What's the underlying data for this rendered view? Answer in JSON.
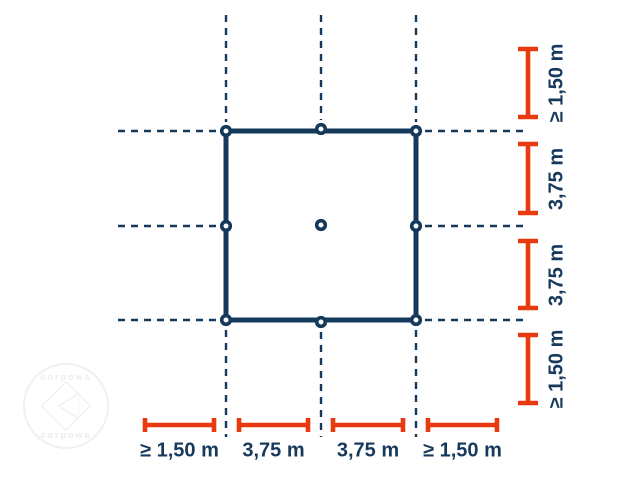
{
  "canvas": {
    "width": 639,
    "height": 479,
    "background": "#ffffff"
  },
  "colors": {
    "navy": "#14395B",
    "red": "#E8390F",
    "label_text": "#17395C",
    "watermark": "#F0F0F0"
  },
  "square": {
    "x": 226,
    "y": 131,
    "width": 190,
    "height": 189,
    "stroke_width": 5
  },
  "anchor_points": {
    "style": {
      "radius": 4.3,
      "ring_width": 3.6
    },
    "points": [
      {
        "name": "top-left",
        "x": 226,
        "y": 131
      },
      {
        "name": "top-center",
        "x": 321,
        "y": 129
      },
      {
        "name": "top-right",
        "x": 416,
        "y": 131
      },
      {
        "name": "middle-left",
        "x": 226,
        "y": 226
      },
      {
        "name": "center",
        "x": 321,
        "y": 225
      },
      {
        "name": "middle-right",
        "x": 416,
        "y": 226
      },
      {
        "name": "bottom-left",
        "x": 226,
        "y": 320
      },
      {
        "name": "bottom-center",
        "x": 321,
        "y": 322
      },
      {
        "name": "bottom-right",
        "x": 416,
        "y": 320
      }
    ]
  },
  "dashed_lines": {
    "style": {
      "width": 2.4,
      "dash": "7 6"
    },
    "vertical": [
      {
        "x": 226,
        "y1": 15,
        "y2": 122
      },
      {
        "x": 321,
        "y1": 15,
        "y2": 120
      },
      {
        "x": 416,
        "y1": 15,
        "y2": 122
      },
      {
        "x": 226,
        "y1": 330,
        "y2": 437
      },
      {
        "x": 321,
        "y1": 332,
        "y2": 437
      },
      {
        "x": 416,
        "y1": 330,
        "y2": 437
      }
    ],
    "horizontal": [
      {
        "y": 131,
        "x1": 118,
        "x2": 217
      },
      {
        "y": 226,
        "x1": 118,
        "x2": 217
      },
      {
        "y": 320,
        "x1": 118,
        "x2": 217
      },
      {
        "y": 131,
        "x1": 425,
        "x2": 526
      },
      {
        "y": 226,
        "x1": 425,
        "x2": 526
      },
      {
        "y": 320,
        "x1": 425,
        "x2": 526
      }
    ]
  },
  "dimensions": {
    "style": {
      "stroke_width": 4.6
    },
    "right_column": {
      "axis_x": 528,
      "cap_length": 20,
      "label_offset": 29,
      "items": [
        {
          "label": "≥ 1,50 m",
          "from": 49,
          "to": 117
        },
        {
          "label": "3,75 m",
          "from": 144,
          "to": 213
        },
        {
          "label": "3,75 m",
          "from": 241,
          "to": 308
        },
        {
          "label": "≥ 1,50 m",
          "from": 335,
          "to": 403
        }
      ]
    },
    "bottom_row": {
      "axis_y": 425,
      "cap_length": 14,
      "label_offset": 26,
      "items": [
        {
          "label": "≥ 1,50 m",
          "from": 145,
          "to": 214
        },
        {
          "label": "3,75 m",
          "from": 239,
          "to": 308
        },
        {
          "label": "3,75 m",
          "from": 333,
          "to": 403
        },
        {
          "label": "≥ 1,50 m",
          "from": 428,
          "to": 497
        }
      ]
    }
  },
  "watermark": {
    "cx": 66,
    "cy": 406,
    "radius": 43,
    "arc_text_top": "corpowa",
    "arc_text_bottom": "corpowa"
  }
}
